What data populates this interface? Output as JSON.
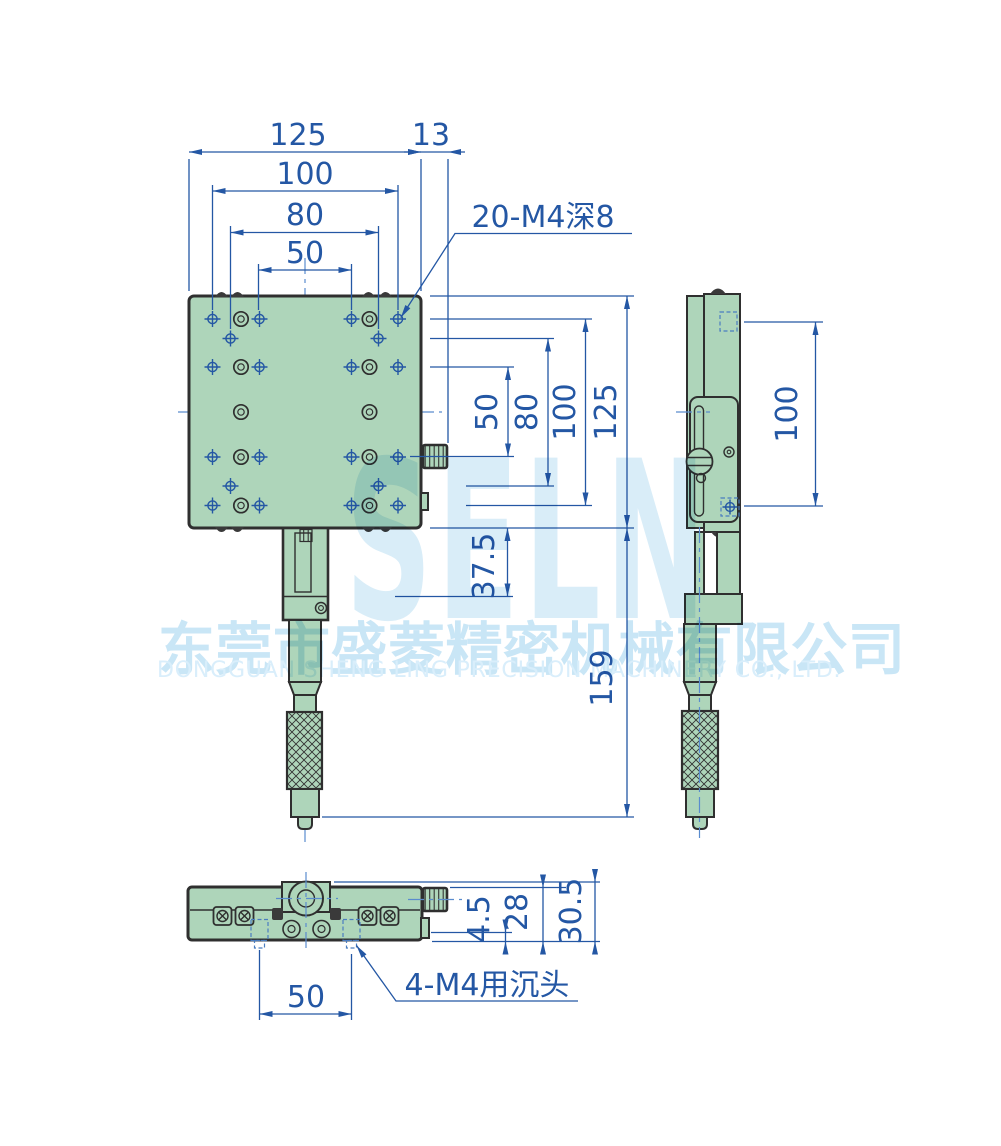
{
  "watermark": {
    "logo": "SELN",
    "company_cn": "东莞市盛菱精密机械有限公司",
    "company_en": "DONGGUAN SHENG LING PRECISION MACHINERY CO., LTD."
  },
  "labels": {
    "top_width": "125",
    "top_gap": "13",
    "top_100": "100",
    "top_80": "80",
    "top_50": "50",
    "right_50": "50",
    "right_80": "80",
    "right_100": "100",
    "right_125": "125",
    "right_37_5": "37.5",
    "right_159": "159",
    "side_100": "100",
    "bot_4_5": "4.5",
    "bot_28": "28",
    "bot_30_5": "30.5",
    "bot_50": "50",
    "callout_holes": "20-M4深8",
    "callout_counterbore": "4-M4用沉头"
  },
  "colors": {
    "dimension_blue": "#2457a4",
    "body_green": "#aed5ba",
    "outline": "#2f2f2f",
    "centerline_blue": "#5a8cce",
    "watermark_blue": "#d9edf8"
  }
}
